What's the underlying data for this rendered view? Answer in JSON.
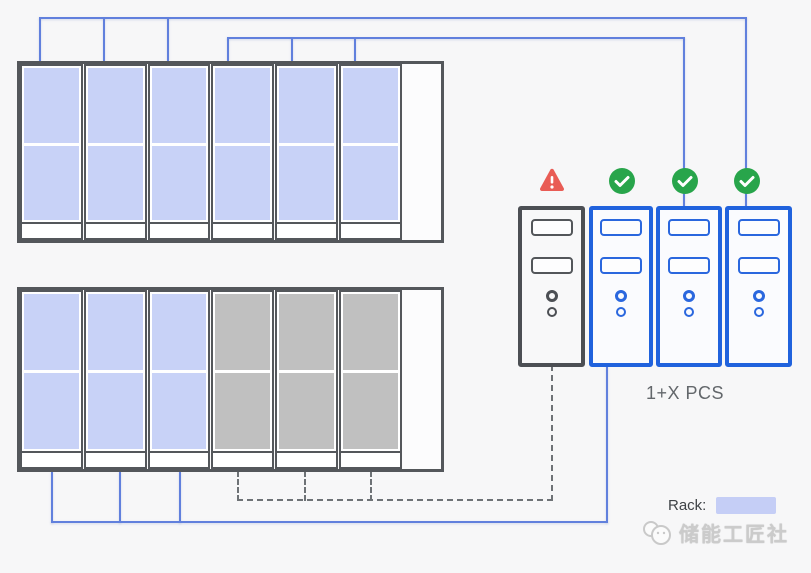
{
  "diagram": {
    "pcs_group_label": "1+X PCS",
    "legend": {
      "label": "Rack:",
      "swatch_color": "#c5cef6"
    },
    "watermark": {
      "text": "储能工匠社",
      "logo": "mascot-logo"
    },
    "colors": {
      "active": "#c8d2f7",
      "inactive": "#c0c0c0",
      "bus_line": "#6180dd",
      "dashed_line": "#6e7276",
      "cabinet_border": "#54575b",
      "pcs_ok_border": "#2062dd",
      "pcs_fault_border": "#4c4f54",
      "fault_red": "#e95c55",
      "ok_green": "#28a54b"
    },
    "cabinets": [
      {
        "name": "battery-cabinet-top",
        "racks": [
          {
            "state": "active"
          },
          {
            "state": "active"
          },
          {
            "state": "active"
          },
          {
            "state": "active"
          },
          {
            "state": "active"
          },
          {
            "state": "active"
          }
        ]
      },
      {
        "name": "battery-cabinet-bottom",
        "racks": [
          {
            "state": "active"
          },
          {
            "state": "active"
          },
          {
            "state": "active"
          },
          {
            "state": "inactive"
          },
          {
            "state": "inactive"
          },
          {
            "state": "inactive"
          }
        ]
      }
    ],
    "pcs_units": [
      {
        "status": "fault",
        "icon": "warning"
      },
      {
        "status": "ok",
        "icon": "check"
      },
      {
        "status": "ok",
        "icon": "check"
      },
      {
        "status": "ok",
        "icon": "check"
      }
    ]
  }
}
